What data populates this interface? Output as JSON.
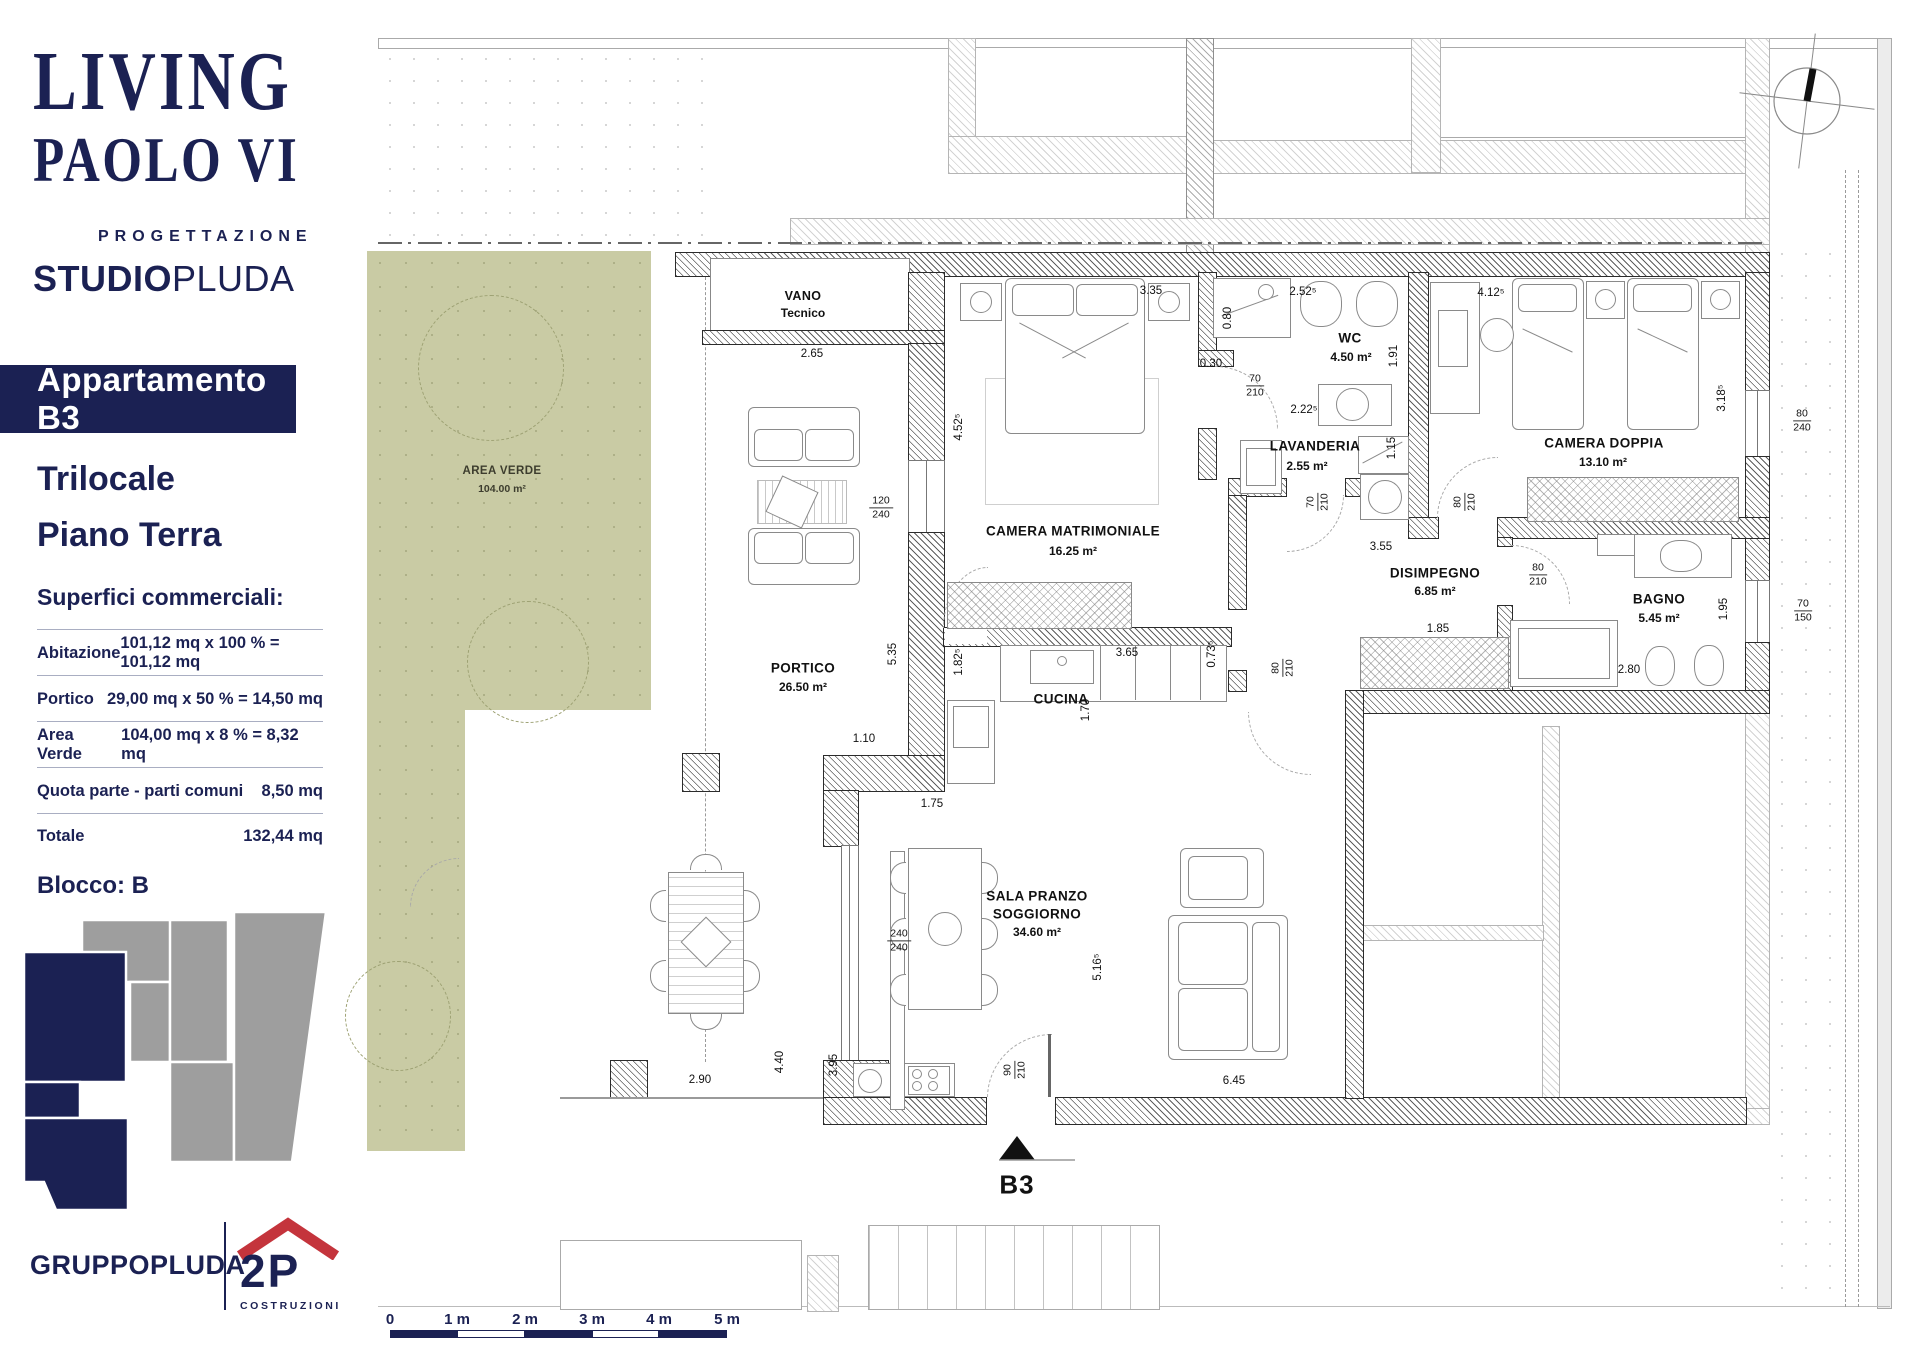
{
  "sidebar": {
    "logo": {
      "line1": "LIVING",
      "line2": "PAOLO VI",
      "tagline": "PROGETTAZIONE",
      "studio_bold": "STUDIO",
      "studio_light": "PLUDA"
    },
    "banner": "Appartamento B3",
    "unit_type": "Trilocale",
    "floor": "Piano Terra",
    "surfaces": {
      "title": "Superfici commerciali:",
      "rows": [
        {
          "label": "Abitazione",
          "value": "101,12 mq x 100 % = 101,12 mq"
        },
        {
          "label": "Portico",
          "value": "29,00 mq x 50 % = 14,50 mq"
        },
        {
          "label": "Area Verde",
          "value": "104,00 mq x 8 % = 8,32 mq"
        },
        {
          "label": "Quota parte - parti comuni",
          "value": "8,50 mq"
        },
        {
          "label": "Totale",
          "value": "132,44 mq"
        }
      ]
    },
    "block": "Blocco: B",
    "footer": {
      "group_normal": "GRUPPO",
      "group_bold": "PLUDA",
      "logo2p": "2P",
      "logo2p_sub": "COSTRUZIONI"
    }
  },
  "plan": {
    "vano": {
      "line1": "VANO",
      "line2": "Tecnico"
    },
    "area_verde": {
      "line1": "AREA VERDE",
      "line2": "104.00 m²"
    },
    "rooms": [
      {
        "name": "CAMERA MATRIMONIALE",
        "area": "16.25 m²"
      },
      {
        "name": "WC",
        "area": "4.50 m²"
      },
      {
        "name": "LAVANDERIA",
        "area": "2.55 m²"
      },
      {
        "name": "CAMERA DOPPIA",
        "area": "13.10 m²"
      },
      {
        "name": "DISIMPEGNO",
        "area": "6.85 m²"
      },
      {
        "name": "BAGNO",
        "area": "5.45 m²"
      },
      {
        "name": "CUCINA",
        "area": ""
      },
      {
        "name": "PORTICO",
        "area": "26.50 m²"
      },
      {
        "name": "SALA PRANZO",
        "name2": "SOGGIORNO",
        "area": "34.60 m²"
      }
    ],
    "unit_label": "B3",
    "dims": [
      "2.65",
      "3.35",
      "2.52⁵",
      "0.30",
      "2.22⁵",
      "4.12⁵",
      "3.55",
      "1.85",
      "2.80",
      "1.10",
      "1.75",
      "2.90",
      "6.45",
      "3.65",
      "0.80",
      "1.91",
      "1.15",
      "3.18⁵",
      "4.52⁵",
      "5.35",
      "1.82⁵",
      "0.73⁵",
      "1.70",
      "5.16⁵",
      "4.40",
      "3.95",
      "1.95"
    ],
    "fractions": [
      {
        "top": "70",
        "bottom": "210"
      },
      {
        "top": "120",
        "bottom": "240"
      },
      {
        "top": "240",
        "bottom": "240"
      },
      {
        "top": "80",
        "bottom": "240"
      },
      {
        "top": "80",
        "bottom": "210"
      },
      {
        "top": "70",
        "bottom": "150"
      },
      {
        "top": "70",
        "bottom": "210"
      },
      {
        "top": "80",
        "bottom": "210"
      },
      {
        "top": "80",
        "bottom": "210"
      },
      {
        "top": "90",
        "bottom": "210"
      }
    ],
    "scale": {
      "labels": [
        "0",
        "1 m",
        "2 m",
        "3 m",
        "4 m",
        "5 m"
      ]
    }
  },
  "colors": {
    "navy": "#1b2153",
    "green": "#c9cba4",
    "red": "#c4343c",
    "gray": "#9e9e9e"
  }
}
